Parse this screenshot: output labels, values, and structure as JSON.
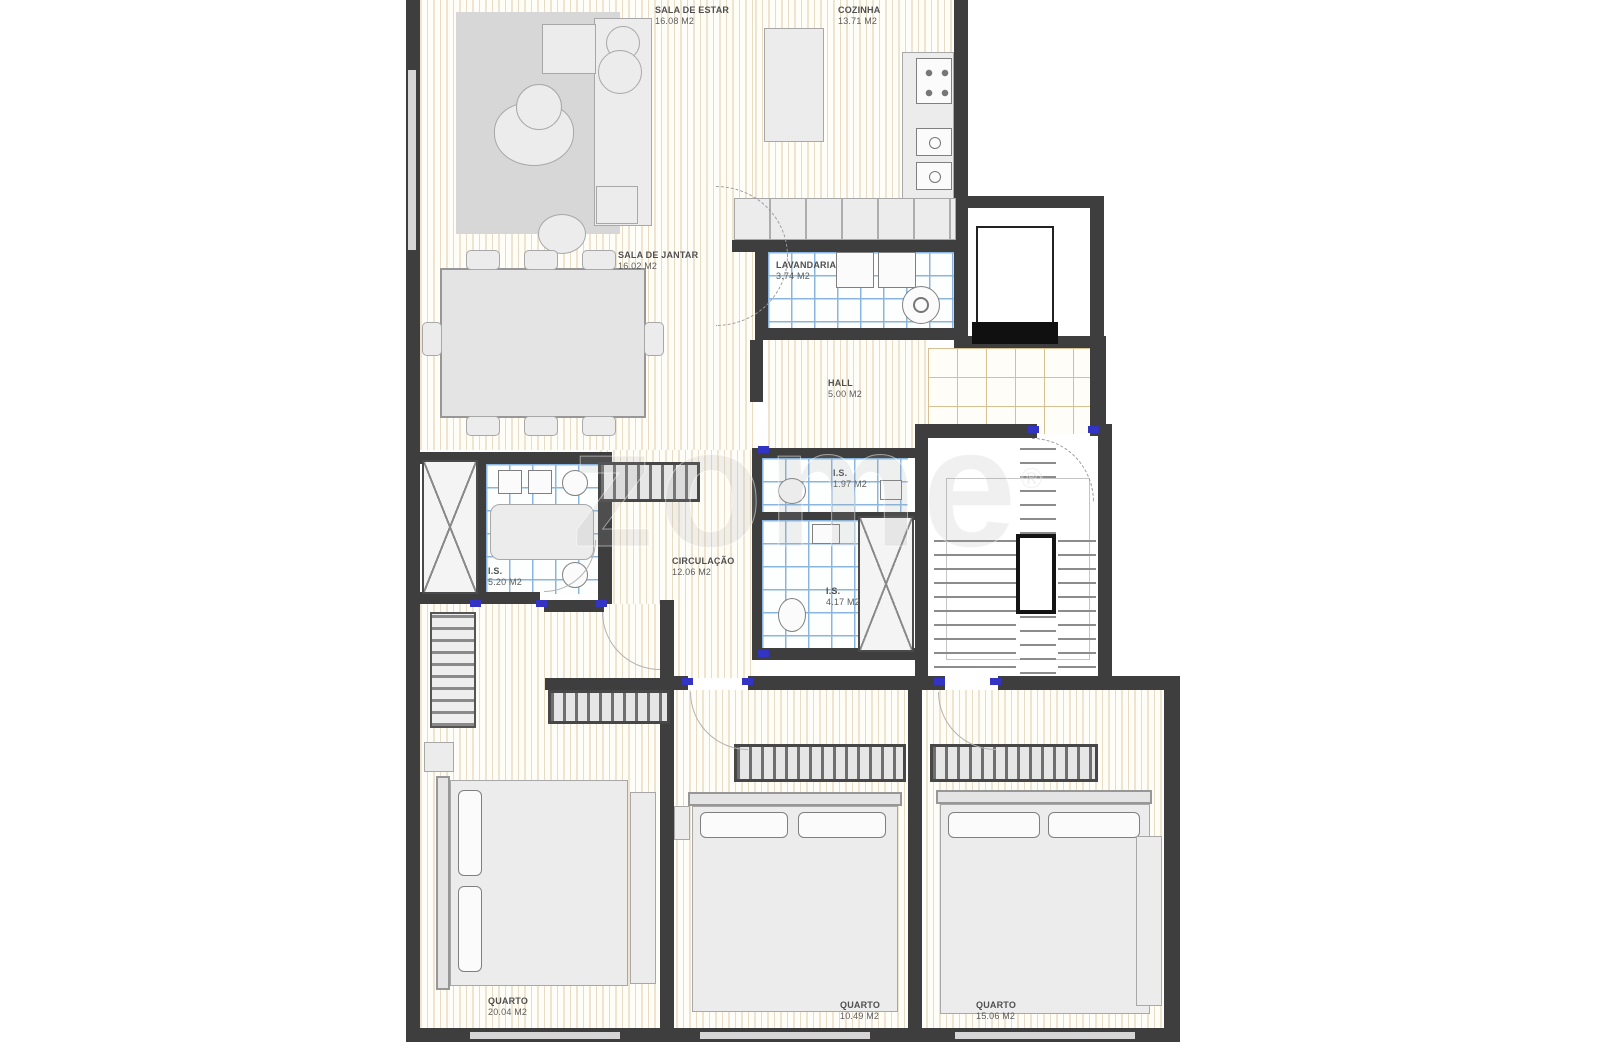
{
  "watermark": {
    "text": "zome",
    "reg": "®"
  },
  "rooms": [
    {
      "name": "SALA DE ESTAR",
      "area": "16.08 M2"
    },
    {
      "name": "COZINHA",
      "area": "13.71 M2"
    },
    {
      "name": "SALA DE JANTAR",
      "area": "16.02 M2"
    },
    {
      "name": "LAVANDARIA",
      "area": "3.74 M2"
    },
    {
      "name": "HALL",
      "area": "5.00 M2"
    },
    {
      "name": "CIRCULAÇÃO",
      "area": "12.06 M2"
    },
    {
      "name": "I.S.",
      "area": "1.97 M2"
    },
    {
      "name": "I.S.",
      "area": "4.17 M2"
    },
    {
      "name": "I.S.",
      "area": "5.20 M2"
    },
    {
      "name": "QUARTO",
      "area": "20.04 M2"
    },
    {
      "name": "QUARTO",
      "area": "10.49 M2"
    },
    {
      "name": "QUARTO",
      "area": "15.06 M2"
    }
  ],
  "colors": {
    "wall": "#3e3e3e",
    "wood_stripe": "#efe4cf",
    "tile_blue": "#8ab5de",
    "tile_beige": "#d9c093",
    "furniture": "#e4e4e4",
    "door_mark_blue": "#3434c4"
  }
}
